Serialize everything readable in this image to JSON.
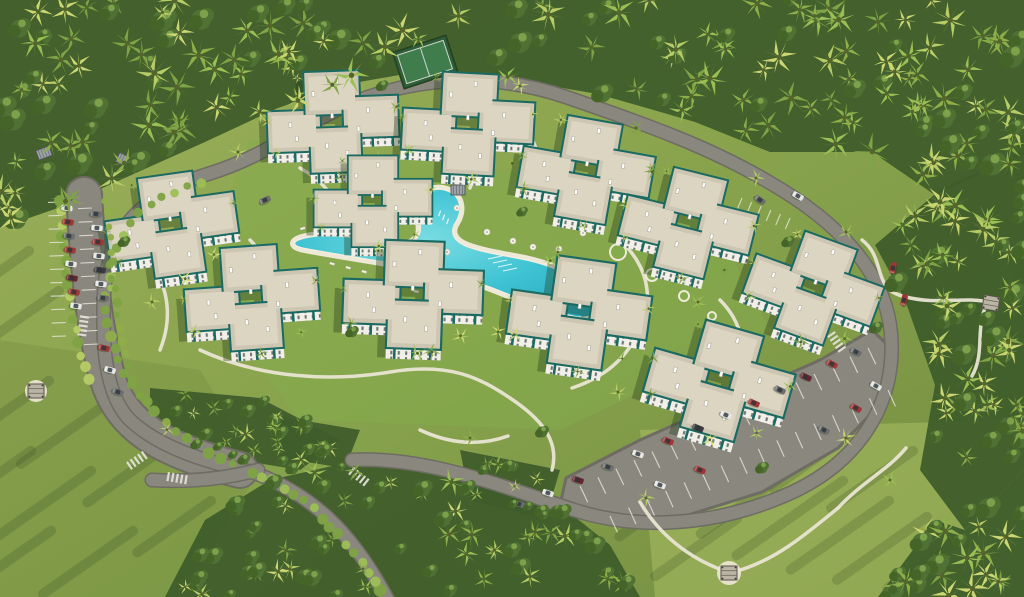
{
  "scene": {
    "description": "aerial-render-tropical-apartment-resort",
    "canvas": {
      "width": 1024,
      "height": 597
    },
    "palette": {
      "grass_a": "#9db05a",
      "grass_b": "#86a14b",
      "grass_c": "#738c42",
      "grass_bright": "#a9bd62",
      "grass_inner": "#84ac4c",
      "forest_dark": "#3f5d2b",
      "forest_mid": "#4e6e33",
      "palm1": "#b7cc66",
      "palm2": "#9cbf55",
      "palm3": "#8fae4a",
      "palm4": "#ccd773",
      "palm5": "#7fa345",
      "tree_dark": "#456428",
      "tree_mid": "#4f7134",
      "tree_hi": "#7da04a",
      "road": "#8a887e",
      "road_edge": "#6e6c63",
      "marking": "#e6e4da",
      "path": "#e9e5d3",
      "roof": "#cdc6b2",
      "roof_light": "#dbd5c2",
      "facade": "#f1efe8",
      "teal": "#1a6a62",
      "teal_dark": "#12504b",
      "window": "#3f4e4c",
      "pool_light": "#7adde2",
      "pool_mid": "#3fc3d3",
      "pool_deep": "#28a9c0",
      "deck": "#eee8d6",
      "court_green": "#3f7d4c",
      "court_border": "#2f5d39",
      "fence": "#24421f",
      "shadow": "#22391a",
      "car_red": "#a03636",
      "car_maroon": "#6b2531",
      "car_white": "#e6e6e4",
      "car_gray": "#6e6e6e",
      "car_dark": "#3c3c40",
      "struct_gray": "#9ba1a7",
      "struct_frame": "#4e5355",
      "pav_roof": "#b9b4a4"
    },
    "lawn": {
      "overlays": [
        {
          "points": "640,430 1024,420 1024,597 655,597",
          "fill": "grass_bright",
          "opacity": 0.55
        },
        {
          "points": "250,140 700,195 770,330 560,430 300,420 195,285",
          "fill": "grass_inner",
          "opacity": 0.5
        },
        {
          "points": "0,340 200,370 260,470 180,597 0,597",
          "fill": "grass_c",
          "opacity": 0.35
        }
      ],
      "streaks": [
        [
          760,
          452,
          120
        ],
        [
          806,
          466,
          130
        ],
        [
          850,
          482,
          140
        ],
        [
          896,
          502,
          130
        ],
        [
          934,
          518,
          120
        ],
        [
          968,
          538,
          100
        ],
        [
          862,
          432,
          110
        ],
        [
          920,
          452,
          110
        ],
        [
          700,
          486,
          100
        ],
        [
          744,
          520,
          110
        ],
        [
          56,
          382,
          110
        ],
        [
          118,
          402,
          120
        ],
        [
          38,
          452,
          120
        ],
        [
          98,
          472,
          130
        ],
        [
          168,
          452,
          100
        ],
        [
          58,
          532,
          120
        ],
        [
          140,
          532,
          120
        ],
        [
          218,
          502,
          100
        ],
        [
          36,
          252,
          80
        ],
        [
          66,
          292,
          90
        ],
        [
          940,
          130,
          0
        ]
      ]
    },
    "forest": {
      "patches": [
        {
          "poly": [
            [
              0,
              0
            ],
            [
              1024,
              0
            ],
            [
              1024,
              155
            ],
            [
              935,
              195
            ],
            [
              872,
              152
            ],
            [
              770,
              152
            ],
            [
              695,
              122
            ],
            [
              598,
              94
            ],
            [
              515,
              80
            ],
            [
              428,
              70
            ],
            [
              348,
              84
            ],
            [
              278,
              108
            ],
            [
              205,
              142
            ],
            [
              138,
              172
            ],
            [
              58,
              208
            ],
            [
              0,
              228
            ]
          ],
          "n": 185,
          "smin": 0.9,
          "smax": 1.7,
          "treeRatio": 0.3
        },
        {
          "poly": [
            [
              1024,
              150
            ],
            [
              1024,
              470
            ],
            [
              965,
              530
            ],
            [
              920,
              470
            ],
            [
              935,
              385
            ],
            [
              905,
              300
            ],
            [
              875,
              245
            ],
            [
              940,
              190
            ]
          ],
          "n": 66,
          "smin": 0.9,
          "smax": 1.6,
          "treeRatio": 0.3
        },
        {
          "poly": [
            [
              1024,
              470
            ],
            [
              1024,
              597
            ],
            [
              878,
              597
            ],
            [
              935,
              520
            ],
            [
              965,
              530
            ]
          ],
          "n": 26,
          "smin": 0.9,
          "smax": 1.6,
          "treeRatio": 0.35
        },
        {
          "poly": [
            [
              165,
              597
            ],
            [
              205,
              520
            ],
            [
              270,
              480
            ],
            [
              350,
              462
            ],
            [
              430,
              462
            ],
            [
              500,
              478
            ],
            [
              560,
              505
            ],
            [
              610,
              545
            ],
            [
              640,
              597
            ]
          ],
          "n": 68,
          "smin": 0.7,
          "smax": 1.3,
          "treeRatio": 0.6
        },
        {
          "poly": [
            [
              150,
              388
            ],
            [
              260,
              398
            ],
            [
              340,
              440
            ],
            [
              300,
              470
            ],
            [
              190,
              452
            ],
            [
              150,
              430
            ]
          ],
          "n": 24,
          "smin": 0.6,
          "smax": 1.1,
          "treeRatio": 0.6
        },
        {
          "poly": [
            [
              460,
              450
            ],
            [
              560,
              470
            ],
            [
              545,
              520
            ],
            [
              470,
              500
            ]
          ],
          "n": 13,
          "smin": 0.6,
          "smax": 1.0,
          "treeRatio": 0.5
        },
        {
          "poly": [
            [
              270,
              415
            ],
            [
              360,
              430
            ],
            [
              345,
              468
            ],
            [
              280,
              458
            ]
          ],
          "n": 11,
          "smin": 0.6,
          "smax": 1.0,
          "treeRatio": 0.5
        }
      ]
    },
    "roads": {
      "loop_d": "M388,600 C352,532 312,494 252,472 C206,462 160,448 130,420 C104,394 102,340 104,296 C106,232 140,195 208,174 C270,155 302,124 352,103 C414,78 490,71 566,97 C648,125 712,148 772,184 C834,220 886,270 891,334 C897,404 858,464 786,495 C712,527 636,530 574,510 C512,490 430,456 352,460",
      "spur_d": "M258,470 C220,480 185,482 152,480",
      "parking_strip_d": "M84,195 C88,260 92,320 108,380 C122,425 160,450 240,470",
      "lot_poly": "566,478 640,440 730,400 820,360 872,330 895,352 886,398 838,448 762,492 678,518 600,520 560,505",
      "stall_rows": [
        [
          62,
          202,
          66,
          336,
          10,
          14
        ],
        [
          92,
          208,
          98,
          344,
          10,
          14
        ],
        [
          580,
          486,
          868,
          348,
          16,
          18
        ],
        [
          610,
          516,
          888,
          390,
          15,
          18
        ],
        [
          742,
          198,
          790,
          218,
          5,
          12
        ]
      ],
      "crosswalks": [
        [
          83,
          327,
          -82
        ],
        [
          176,
          478,
          10
        ],
        [
          358,
          476,
          38
        ],
        [
          836,
          341,
          55
        ],
        [
          136,
          461,
          -35
        ]
      ]
    },
    "hedges": [
      {
        "d": "M382,592 C344,532 306,494 244,468",
        "r": 5,
        "step": 12,
        "tone": "palm2"
      },
      {
        "d": "M232,462 C150,430 104,362 106,294",
        "r": 4.5,
        "step": 13,
        "tone": "palm3"
      },
      {
        "d": "M112,290 C110,230 140,200 205,180",
        "r": 4,
        "step": 14,
        "tone": "palm2"
      },
      {
        "d": "M60,200 C64,260 70,330 90,385",
        "r": 4.5,
        "step": 12,
        "tone": "palm1"
      },
      {
        "d": "M106,200 C110,260 116,330 134,392",
        "r": 4,
        "step": 13,
        "tone": "palm3"
      }
    ],
    "footpaths": [
      "M862,240 C886,258 872,288 902,296 C938,306 962,296 988,302",
      "M988,302 C974,326 986,352 972,376",
      "M640,502 C660,536 690,558 722,570",
      "M737,571 C776,560 806,534 838,508",
      "M838,508 C862,482 888,470 906,448",
      "M200,350 C260,378 330,382 390,372 C450,362 480,378 510,398 C540,418 560,440 552,470",
      "M300,168 C332,186 344,210 338,236",
      "M520,120 C540,146 544,170 534,192",
      "M620,240 C652,270 656,308 632,344 C616,368 596,380 572,388",
      "M150,260 C170,290 172,320 160,350",
      "M720,300 C742,322 748,350 736,378",
      "M420,430 C450,444 480,446 508,436",
      "M250,240 C270,260 272,284 260,306",
      "M445,130 C470,148 478,168 470,188"
    ],
    "pool": {
      "water_d": "M298,240 C318,232 352,236 380,242 C408,248 416,244 420,232 C422,220 414,212 418,202 C423,190 438,186 450,192 C462,198 462,212 456,222 C450,231 452,240 466,246 C492,256 520,256 548,266 C576,276 598,288 600,302 C601,314 588,320 572,316 C548,310 522,300 492,288 C466,278 430,270 396,264 C360,258 322,252 302,248 C294,246 292,243 298,240 Z",
      "lane_lines": [
        [
          488,
          259,
          14
        ],
        [
          493,
          263,
          14
        ],
        [
          498,
          267,
          14
        ],
        [
          503,
          271,
          14
        ]
      ],
      "steps": [
        [
          438,
          216,
          -70
        ],
        [
          442,
          220,
          -70
        ],
        [
          446,
          224,
          -70
        ]
      ],
      "loungers": [
        [
          330,
          262,
          15
        ],
        [
          346,
          266,
          15
        ],
        [
          362,
          270,
          15
        ],
        [
          414,
          290,
          10
        ],
        [
          432,
          294,
          10
        ],
        [
          520,
          308,
          30
        ],
        [
          538,
          316,
          30
        ],
        [
          300,
          228,
          -15
        ],
        [
          560,
          268,
          40
        ],
        [
          582,
          290,
          40
        ]
      ],
      "umbrellas": [
        [
          423,
          190
        ],
        [
          457,
          208
        ],
        [
          487,
          232
        ],
        [
          513,
          241
        ],
        [
          533,
          247
        ],
        [
          559,
          249
        ],
        [
          583,
          233
        ],
        [
          447,
          252
        ],
        [
          402,
          256
        ],
        [
          360,
          250
        ]
      ],
      "rings": [
        [
          618,
          252,
          8
        ],
        [
          652,
          275,
          6
        ],
        [
          684,
          296,
          5
        ],
        [
          712,
          316,
          4
        ]
      ]
    },
    "court": {
      "x": 425,
      "y": 62,
      "rot": -18
    },
    "pergolas": [
      [
        458,
        190,
        0
      ],
      [
        556,
        167,
        12
      ],
      [
        44,
        153,
        -20
      ],
      [
        124,
        160,
        25
      ],
      [
        452,
        88,
        -18
      ]
    ],
    "pavilions": [
      [
        36,
        391,
        0,
        11
      ],
      [
        991,
        303,
        10,
        0
      ],
      [
        729,
        573,
        0,
        12
      ]
    ],
    "buildings": [
      [
        333,
        125,
        -2,
        1.0
      ],
      [
        468,
        127,
        3,
        1.0
      ],
      [
        586,
        173,
        10,
        1.0
      ],
      [
        688,
        226,
        14,
        1.0
      ],
      [
        172,
        228,
        -8,
        1.0
      ],
      [
        252,
        301,
        -4,
        1.02
      ],
      [
        373,
        204,
        0,
        0.9
      ],
      [
        413,
        298,
        2,
        1.06
      ],
      [
        579,
        316,
        8,
        1.06
      ],
      [
        719,
        384,
        16,
        1.08
      ],
      [
        813,
        291,
        20,
        1.0
      ]
    ],
    "building_palms": [
      [
        -58,
        26,
        0.55
      ],
      [
        46,
        34,
        0.6
      ],
      [
        64,
        -16,
        0.5
      ],
      [
        -34,
        -48,
        0.5
      ],
      [
        6,
        52,
        0.62
      ],
      [
        -66,
        -6,
        0.45
      ]
    ],
    "trees": [
      [
        238,
        152,
        0.62,
        "p"
      ],
      [
        298,
        96,
        0.6,
        "p"
      ],
      [
        382,
        86,
        0.55,
        "t"
      ],
      [
        520,
        86,
        0.6,
        "p"
      ],
      [
        636,
        128,
        0.65,
        "p"
      ],
      [
        756,
        178,
        0.6,
        "p"
      ],
      [
        846,
        232,
        0.62,
        "p"
      ],
      [
        876,
        328,
        0.6,
        "t"
      ],
      [
        846,
        438,
        0.66,
        "p"
      ],
      [
        762,
        468,
        0.6,
        "t"
      ],
      [
        646,
        498,
        0.62,
        "p"
      ],
      [
        542,
        432,
        0.6,
        "t"
      ],
      [
        470,
        438,
        0.58,
        "p"
      ],
      [
        306,
        428,
        0.6,
        "t"
      ],
      [
        214,
        408,
        0.62,
        "p"
      ],
      [
        152,
        302,
        0.6,
        "p"
      ],
      [
        124,
        242,
        0.55,
        "t"
      ],
      [
        432,
        352,
        0.6,
        "p"
      ],
      [
        498,
        332,
        0.55,
        "p"
      ],
      [
        352,
        332,
        0.58,
        "t"
      ],
      [
        618,
        392,
        0.6,
        "p"
      ],
      [
        698,
        302,
        0.58,
        "p"
      ],
      [
        558,
        252,
        0.55,
        "p"
      ],
      [
        522,
        212,
        0.5,
        "t"
      ],
      [
        652,
        172,
        0.55,
        "p"
      ],
      [
        788,
        242,
        0.58,
        "t"
      ],
      [
        890,
        480,
        0.6,
        "p"
      ],
      [
        940,
        560,
        0.7,
        "p"
      ]
    ],
    "cars": [
      [
        67,
        208,
        8,
        "car_white"
      ],
      [
        68,
        222,
        8,
        "car_red"
      ],
      [
        69,
        236,
        8,
        "car_gray"
      ],
      [
        70,
        250,
        9,
        "car_red"
      ],
      [
        71,
        264,
        9,
        "car_white"
      ],
      [
        72,
        278,
        10,
        "car_maroon"
      ],
      [
        74,
        292,
        10,
        "car_red"
      ],
      [
        76,
        306,
        10,
        "car_white"
      ],
      [
        96,
        214,
        6,
        "car_gray"
      ],
      [
        97,
        228,
        6,
        "car_white"
      ],
      [
        98,
        242,
        7,
        "car_red"
      ],
      [
        99,
        256,
        7,
        "car_white"
      ],
      [
        100,
        270,
        8,
        "car_dark"
      ],
      [
        101,
        284,
        8,
        "car_white"
      ],
      [
        103,
        298,
        8,
        "car_gray"
      ],
      [
        104,
        348,
        14,
        "car_red"
      ],
      [
        110,
        370,
        16,
        "car_white"
      ],
      [
        118,
        392,
        20,
        "car_gray"
      ],
      [
        856,
        352,
        28,
        "car_gray"
      ],
      [
        832,
        364,
        28,
        "car_red"
      ],
      [
        806,
        377,
        26,
        "car_maroon"
      ],
      [
        780,
        390,
        26,
        "car_gray"
      ],
      [
        754,
        403,
        24,
        "car_red"
      ],
      [
        726,
        415,
        24,
        "car_white"
      ],
      [
        698,
        428,
        22,
        "car_dark"
      ],
      [
        668,
        441,
        22,
        "car_red"
      ],
      [
        638,
        454,
        20,
        "car_white"
      ],
      [
        608,
        467,
        20,
        "car_gray"
      ],
      [
        578,
        480,
        18,
        "car_maroon"
      ],
      [
        548,
        493,
        18,
        "car_white"
      ],
      [
        519,
        504,
        16,
        "car_gray"
      ],
      [
        876,
        386,
        30,
        "car_white"
      ],
      [
        856,
        408,
        30,
        "car_red"
      ],
      [
        824,
        430,
        28,
        "car_gray"
      ],
      [
        700,
        470,
        22,
        "car_red"
      ],
      [
        660,
        485,
        20,
        "car_white"
      ],
      [
        893,
        268,
        -78,
        "car_red"
      ],
      [
        899,
        284,
        -78,
        "car_maroon"
      ],
      [
        904,
        300,
        -76,
        "car_red"
      ],
      [
        760,
        200,
        35,
        "car_gray"
      ],
      [
        798,
        196,
        30,
        "car_white"
      ],
      [
        265,
        200,
        -25,
        "car_gray"
      ]
    ]
  }
}
